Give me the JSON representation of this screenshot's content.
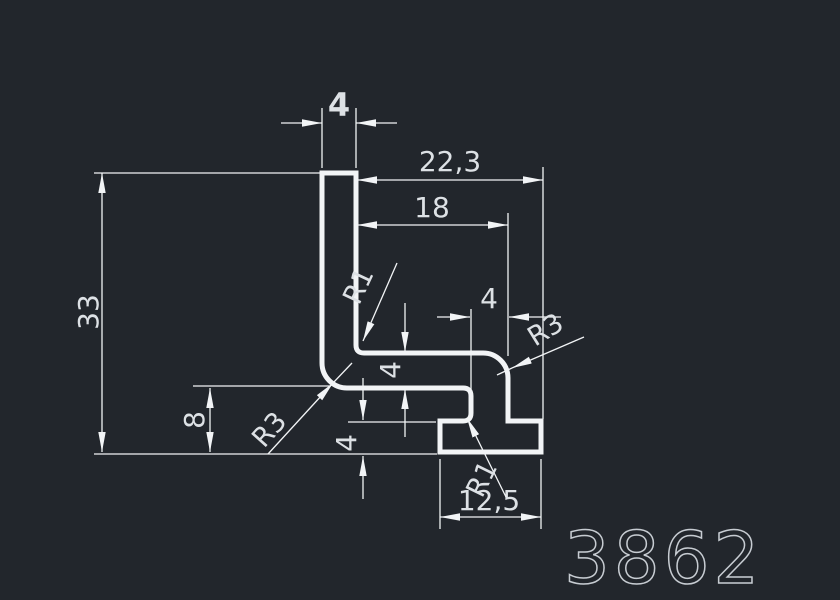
{
  "part_number": "3862",
  "dimensions": {
    "top_width": "4",
    "overall_width": "22,3",
    "inner_width": "18",
    "overall_height": "33",
    "foot_height": "8",
    "arm_thickness": "4",
    "flange_height": "4",
    "neck_width": "4",
    "foot_width": "12,5"
  },
  "radii": {
    "leg_inner": "R1",
    "leg_outer": "R3",
    "neck_outer": "R3",
    "foot_inner": "R1"
  },
  "colors": {
    "background": "#22262c",
    "line": "#f2f4f6",
    "text": "#dde1e5",
    "part_number": "#c7ccd2"
  }
}
